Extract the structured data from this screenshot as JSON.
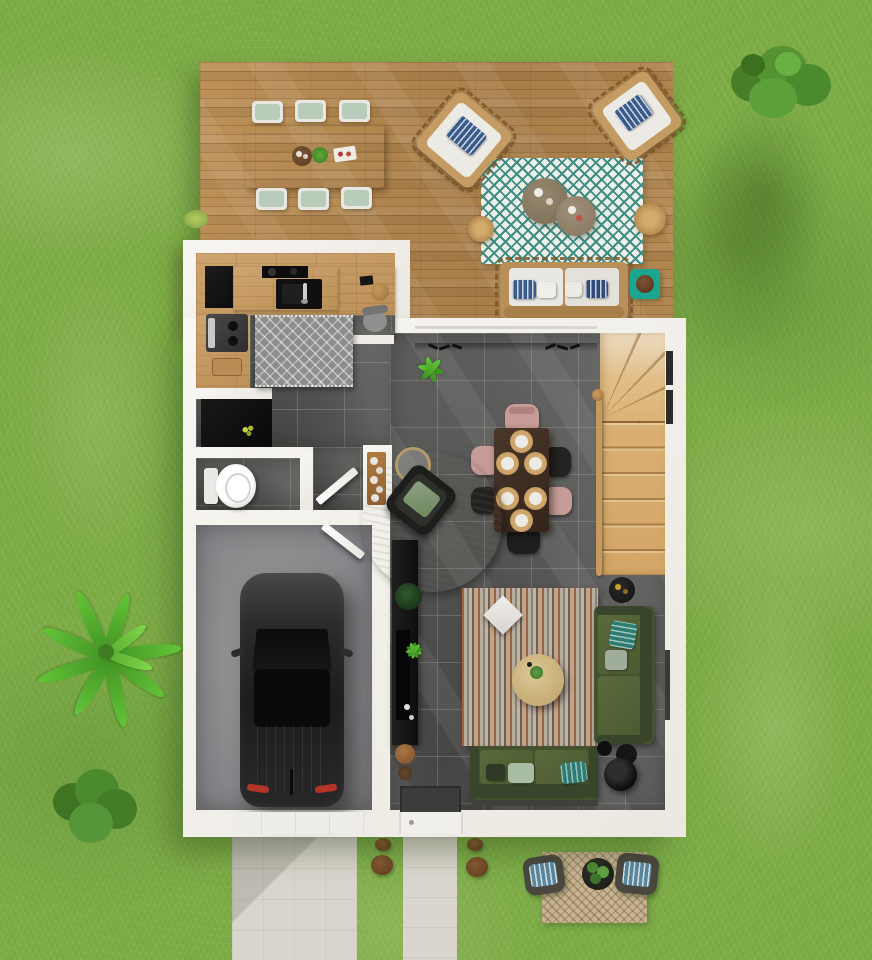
{
  "meta": {
    "type": "3d-floor-plan-render",
    "view": "top-down",
    "floor": "ground-floor",
    "description": "Top-down 3D render of a house ground floor: wooden terrace with outdoor lounge and dining set, kitchen, WC, hall, garage with parked car, open living-dining room, winder staircase, lawn with trees, driveway and front walkway"
  },
  "palette": {
    "grass": "#7CAB45",
    "deck_wood": "#B48A53",
    "interior_wood": "#C8995E",
    "tile_floor": "#5C5C5A",
    "wall_white": "#F3F1EC",
    "garage_floor": "#8F8F8F",
    "concrete_path": "#D9D5CC",
    "stair_wood": "#DCB377",
    "sofa_green": "#4C5B33",
    "teal_accent": "#1BA78F",
    "outdoor_rug_teal": "#3E8D84",
    "dining_chair_pink": "#C79B96",
    "car_body": "#222222",
    "placemat_rattan": "#C59A66",
    "living_rug_rust": "#A4613F"
  },
  "terrace": {
    "name": "wooden terrace",
    "dining_table_seats": 6,
    "dining_cushion_color": "#B9CCB9",
    "wicker_lounge_chairs": 2,
    "lounge_pillow_style": "blue zigzag",
    "outdoor_rug": "teal chevron",
    "round_coffee_tables": 2,
    "rattan_poufs": 2,
    "outdoor_sofa_pillows": 4,
    "side_table_color": "#1BA78F"
  },
  "rooms": [
    {
      "name": "kitchen",
      "floor": "oak plank",
      "items": [
        "tall black cabinet",
        "induction hob",
        "black sink",
        "coffee machine",
        "desk with chair and stool",
        "zigzag rug",
        "storage closet with black unit"
      ]
    },
    {
      "name": "wc",
      "floor": "dark tile",
      "items": [
        "toilet"
      ]
    },
    {
      "name": "hall",
      "floor": "dark tile",
      "items": [
        "decor console with plates",
        "wc door",
        "garage door"
      ]
    },
    {
      "name": "garage",
      "floor": "concrete",
      "items": [
        "parked car"
      ]
    },
    {
      "name": "living-dining",
      "floor": "dark tile",
      "items": [
        "dining table with 6 chairs",
        "round rug with armchair",
        "glass side table",
        "striped rug",
        "round coffee table",
        "green sofa right",
        "green sofa bottom",
        "floor lamp",
        "tv sideboard with plants",
        "side table",
        "doormat",
        "wall hooks"
      ]
    },
    {
      "name": "staircase",
      "kind": "winder stairs with handrail",
      "steps_visible": 11
    }
  ],
  "yard": {
    "trees": [
      "shrub top-right",
      "banana palm left",
      "shrub bottom-left",
      "grass tuft at deck corner"
    ],
    "paths": [
      "garage driveway",
      "front-door walkway"
    ],
    "stepping_stones": 4,
    "back_patio": {
      "mat": "beige chevron",
      "chairs": 2,
      "planter": 1
    }
  },
  "vehicle": {
    "type": "car",
    "color": "#222222",
    "location": "garage",
    "taillight_color": "#B33326"
  }
}
